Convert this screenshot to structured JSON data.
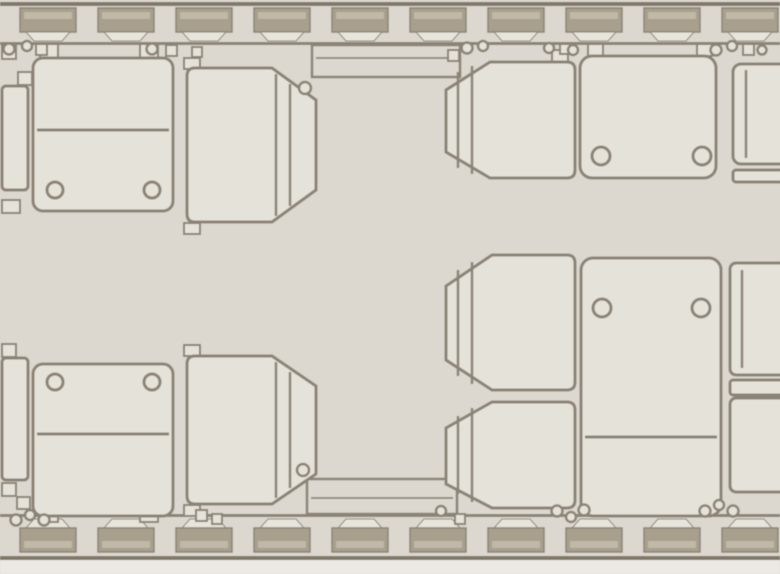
{
  "meta": {
    "title": "Business jet cabin floor plan — top view with club seating"
  },
  "colors": {
    "background": "#dcd8d0",
    "seat_fill": "#e5e2da",
    "outline": "#8b8375",
    "wall_block": "#a89f8d",
    "wall_block_inner": "#c1b9a7",
    "wall_reveal": "#e7e4dc",
    "edge_band": "#80796a",
    "bottom_strip": "#ebe9e3"
  },
  "canvas": {
    "w": 780,
    "h": 574
  },
  "windows": {
    "count": 10,
    "first_x": 20,
    "pitch": 78,
    "width": 56
  },
  "top_wall": {
    "edge_line_y": 2,
    "edge_line_h": 4,
    "window_y": 8,
    "window_h": 24,
    "reveal_y": 32,
    "reveal_h": 9,
    "rail_y": 42,
    "rail_h": 3
  },
  "bottom_wall": {
    "rail_y": 514,
    "rail_h": 3,
    "reveal_y": 519,
    "reveal_h": 9,
    "window_y": 528,
    "window_h": 24,
    "edge_line_y": 556,
    "edge_line_h": 4,
    "strip_y": 560,
    "strip_h": 14
  },
  "ledges": [
    {
      "id": "sideledge-top",
      "x": 312,
      "y": 45,
      "w": 148,
      "h": 32,
      "inner_line": [
        316,
        58,
        456,
        58
      ]
    },
    {
      "id": "sideledge-bottom",
      "x": 307,
      "y": 479,
      "w": 150,
      "h": 35,
      "inner_line": [
        311,
        498,
        453,
        498
      ]
    }
  ],
  "seats": [
    {
      "id": "seat-forward-left-window",
      "facing": "aft",
      "tabs": [
        [
          40,
          44,
          18,
          14
        ],
        [
          140,
          44,
          18,
          14
        ]
      ],
      "body_rect": [
        33,
        58,
        140,
        153
      ],
      "rx": 10,
      "divider": [
        37,
        130,
        169,
        130
      ],
      "circles": [
        [
          55,
          190,
          8
        ],
        [
          152,
          190,
          8
        ]
      ]
    },
    {
      "id": "seat-forward-left-aisle",
      "facing": "left",
      "path": "M195,68 L272,68 L316,100 L316,190 L272,222 L195,222 Q187,222 187,214 L187,76 Q187,68 195,68 Z",
      "inner_lines": [
        [
          276,
          74,
          276,
          216
        ],
        [
          290,
          84,
          290,
          206
        ]
      ],
      "tabs": [
        [
          184,
          58,
          16,
          11
        ],
        [
          184,
          223,
          16,
          11
        ]
      ],
      "circles": [
        [
          305,
          88,
          6
        ]
      ]
    },
    {
      "id": "seat-forward-right-aisle",
      "facing": "right",
      "path": "M567,62 L490,62 L446,90 L446,152 L490,178 L567,178 Q575,178 575,170 L575,70 Q575,62 567,62 Z",
      "inner_lines": [
        [
          458,
          72,
          458,
          168
        ],
        [
          472,
          66,
          472,
          174
        ]
      ],
      "tabs": [
        [
          552,
          50,
          16,
          12
        ]
      ]
    },
    {
      "id": "seat-forward-right-window",
      "facing": "aft",
      "tabs": [
        [
          588,
          44,
          15,
          12
        ],
        [
          697,
          44,
          15,
          12
        ]
      ],
      "body_rect": [
        580,
        56,
        136,
        122
      ],
      "rx": 12,
      "circles": [
        [
          601,
          156,
          9
        ],
        [
          702,
          156,
          9
        ]
      ]
    },
    {
      "id": "seat-aft-left-window",
      "facing": "forward",
      "tabs": [
        [
          40,
          510,
          18,
          12
        ],
        [
          140,
          510,
          18,
          12
        ]
      ],
      "body_rect": [
        33,
        364,
        140,
        152
      ],
      "rx": 10,
      "divider": [
        37,
        434,
        169,
        434
      ],
      "circles": [
        [
          55,
          382,
          8
        ],
        [
          152,
          382,
          8
        ]
      ]
    },
    {
      "id": "seat-aft-left-aisle",
      "facing": "left",
      "path": "M195,356 L272,356 L316,386 L316,474 L272,504 L195,504 Q187,504 187,496 L187,364 Q187,356 195,356 Z",
      "inner_lines": [
        [
          276,
          362,
          276,
          498
        ],
        [
          290,
          372,
          290,
          488
        ]
      ],
      "tabs": [
        [
          184,
          345,
          16,
          11
        ],
        [
          184,
          505,
          16,
          11
        ]
      ],
      "circles": [
        [
          303,
          470,
          6
        ]
      ]
    },
    {
      "id": "seat-aft-right-aisle-upper",
      "facing": "right",
      "path": "M567,255 L492,255 L446,286 L446,360 L492,390 L567,390 Q575,390 575,382 L575,263 Q575,255 567,255 Z",
      "inner_lines": [
        [
          458,
          270,
          458,
          376
        ],
        [
          472,
          262,
          472,
          384
        ]
      ]
    },
    {
      "id": "seat-aft-right-aisle-lower",
      "facing": "right",
      "path": "M567,402 L492,402 L446,428 L446,484 L492,508 L567,508 Q575,508 575,500 L575,410 Q575,402 567,402 Z",
      "inner_lines": [
        [
          458,
          416,
          458,
          494
        ],
        [
          472,
          408,
          472,
          502
        ]
      ]
    },
    {
      "id": "seat-aft-right-window",
      "facing": "forward",
      "body_rect": [
        581,
        258,
        140,
        258
      ],
      "rx": 12,
      "divider": [
        585,
        437,
        717,
        437
      ],
      "circles": [
        [
          602,
          308,
          9
        ],
        [
          701,
          308,
          9
        ]
      ]
    }
  ],
  "edge_units": [
    {
      "id": "seat-edge-top-left",
      "rects": [
        [
          2,
          86,
          26,
          104,
          4
        ]
      ],
      "squares": [
        [
          2,
          46,
          14,
          13
        ],
        [
          18,
          72,
          14,
          13
        ],
        [
          2,
          200,
          18,
          13
        ]
      ]
    },
    {
      "id": "seat-edge-bottom-left",
      "rects": [
        [
          2,
          358,
          26,
          122,
          4
        ]
      ],
      "squares": [
        [
          2,
          344,
          14,
          13
        ],
        [
          2,
          483,
          14,
          13
        ],
        [
          17,
          497,
          13,
          12
        ]
      ]
    },
    {
      "id": "seat-edge-top-right",
      "rects": [
        [
          733,
          64,
          60,
          100,
          8
        ],
        [
          733,
          170,
          60,
          12,
          3
        ]
      ],
      "lines": [
        [
          746,
          70,
          746,
          158
        ]
      ]
    },
    {
      "id": "seat-edge-right-middle",
      "rects": [
        [
          730,
          263,
          60,
          112,
          6
        ],
        [
          730,
          380,
          60,
          15,
          3
        ],
        [
          730,
          398,
          60,
          94,
          6
        ]
      ],
      "lines": [
        [
          742,
          270,
          742,
          368
        ]
      ]
    }
  ],
  "fittings": {
    "top": [
      {
        "t": "c",
        "x": 9,
        "y": 49,
        "r": 5.5
      },
      {
        "t": "c",
        "x": 27,
        "y": 46,
        "r": 5
      },
      {
        "t": "s",
        "x": 36,
        "y": 44,
        "s": 11
      },
      {
        "t": "c",
        "x": 152,
        "y": 49,
        "r": 5.5
      },
      {
        "t": "s",
        "x": 166,
        "y": 45,
        "s": 11
      },
      {
        "t": "s",
        "x": 192,
        "y": 47,
        "s": 10
      },
      {
        "t": "s",
        "x": 448,
        "y": 50,
        "s": 11
      },
      {
        "t": "c",
        "x": 467,
        "y": 48,
        "r": 5.5
      },
      {
        "t": "c",
        "x": 483,
        "y": 46,
        "r": 5
      },
      {
        "t": "c",
        "x": 549,
        "y": 48,
        "r": 5
      },
      {
        "t": "s",
        "x": 560,
        "y": 44,
        "s": 10
      },
      {
        "t": "c",
        "x": 573,
        "y": 50,
        "r": 5
      },
      {
        "t": "c",
        "x": 716,
        "y": 50,
        "r": 5.5
      },
      {
        "t": "c",
        "x": 732,
        "y": 46,
        "r": 5
      },
      {
        "t": "s",
        "x": 743,
        "y": 44,
        "s": 11
      },
      {
        "t": "c",
        "x": 762,
        "y": 50,
        "r": 4.5
      }
    ],
    "bottom": [
      {
        "t": "c",
        "x": 16,
        "y": 520,
        "r": 5.5
      },
      {
        "t": "c",
        "x": 30,
        "y": 515,
        "r": 5
      },
      {
        "t": "c",
        "x": 44,
        "y": 520,
        "r": 5.5
      },
      {
        "t": "s",
        "x": 196,
        "y": 510,
        "s": 11
      },
      {
        "t": "s",
        "x": 212,
        "y": 514,
        "s": 10
      },
      {
        "t": "c",
        "x": 441,
        "y": 511,
        "r": 5
      },
      {
        "t": "s",
        "x": 455,
        "y": 514,
        "s": 10
      },
      {
        "t": "c",
        "x": 557,
        "y": 511,
        "r": 5.5
      },
      {
        "t": "c",
        "x": 571,
        "y": 517,
        "r": 5
      },
      {
        "t": "c",
        "x": 584,
        "y": 510,
        "r": 5.5
      },
      {
        "t": "c",
        "x": 705,
        "y": 511,
        "r": 5.5
      },
      {
        "t": "c",
        "x": 719,
        "y": 505,
        "r": 5
      },
      {
        "t": "c",
        "x": 733,
        "y": 511,
        "r": 5.5
      }
    ]
  }
}
